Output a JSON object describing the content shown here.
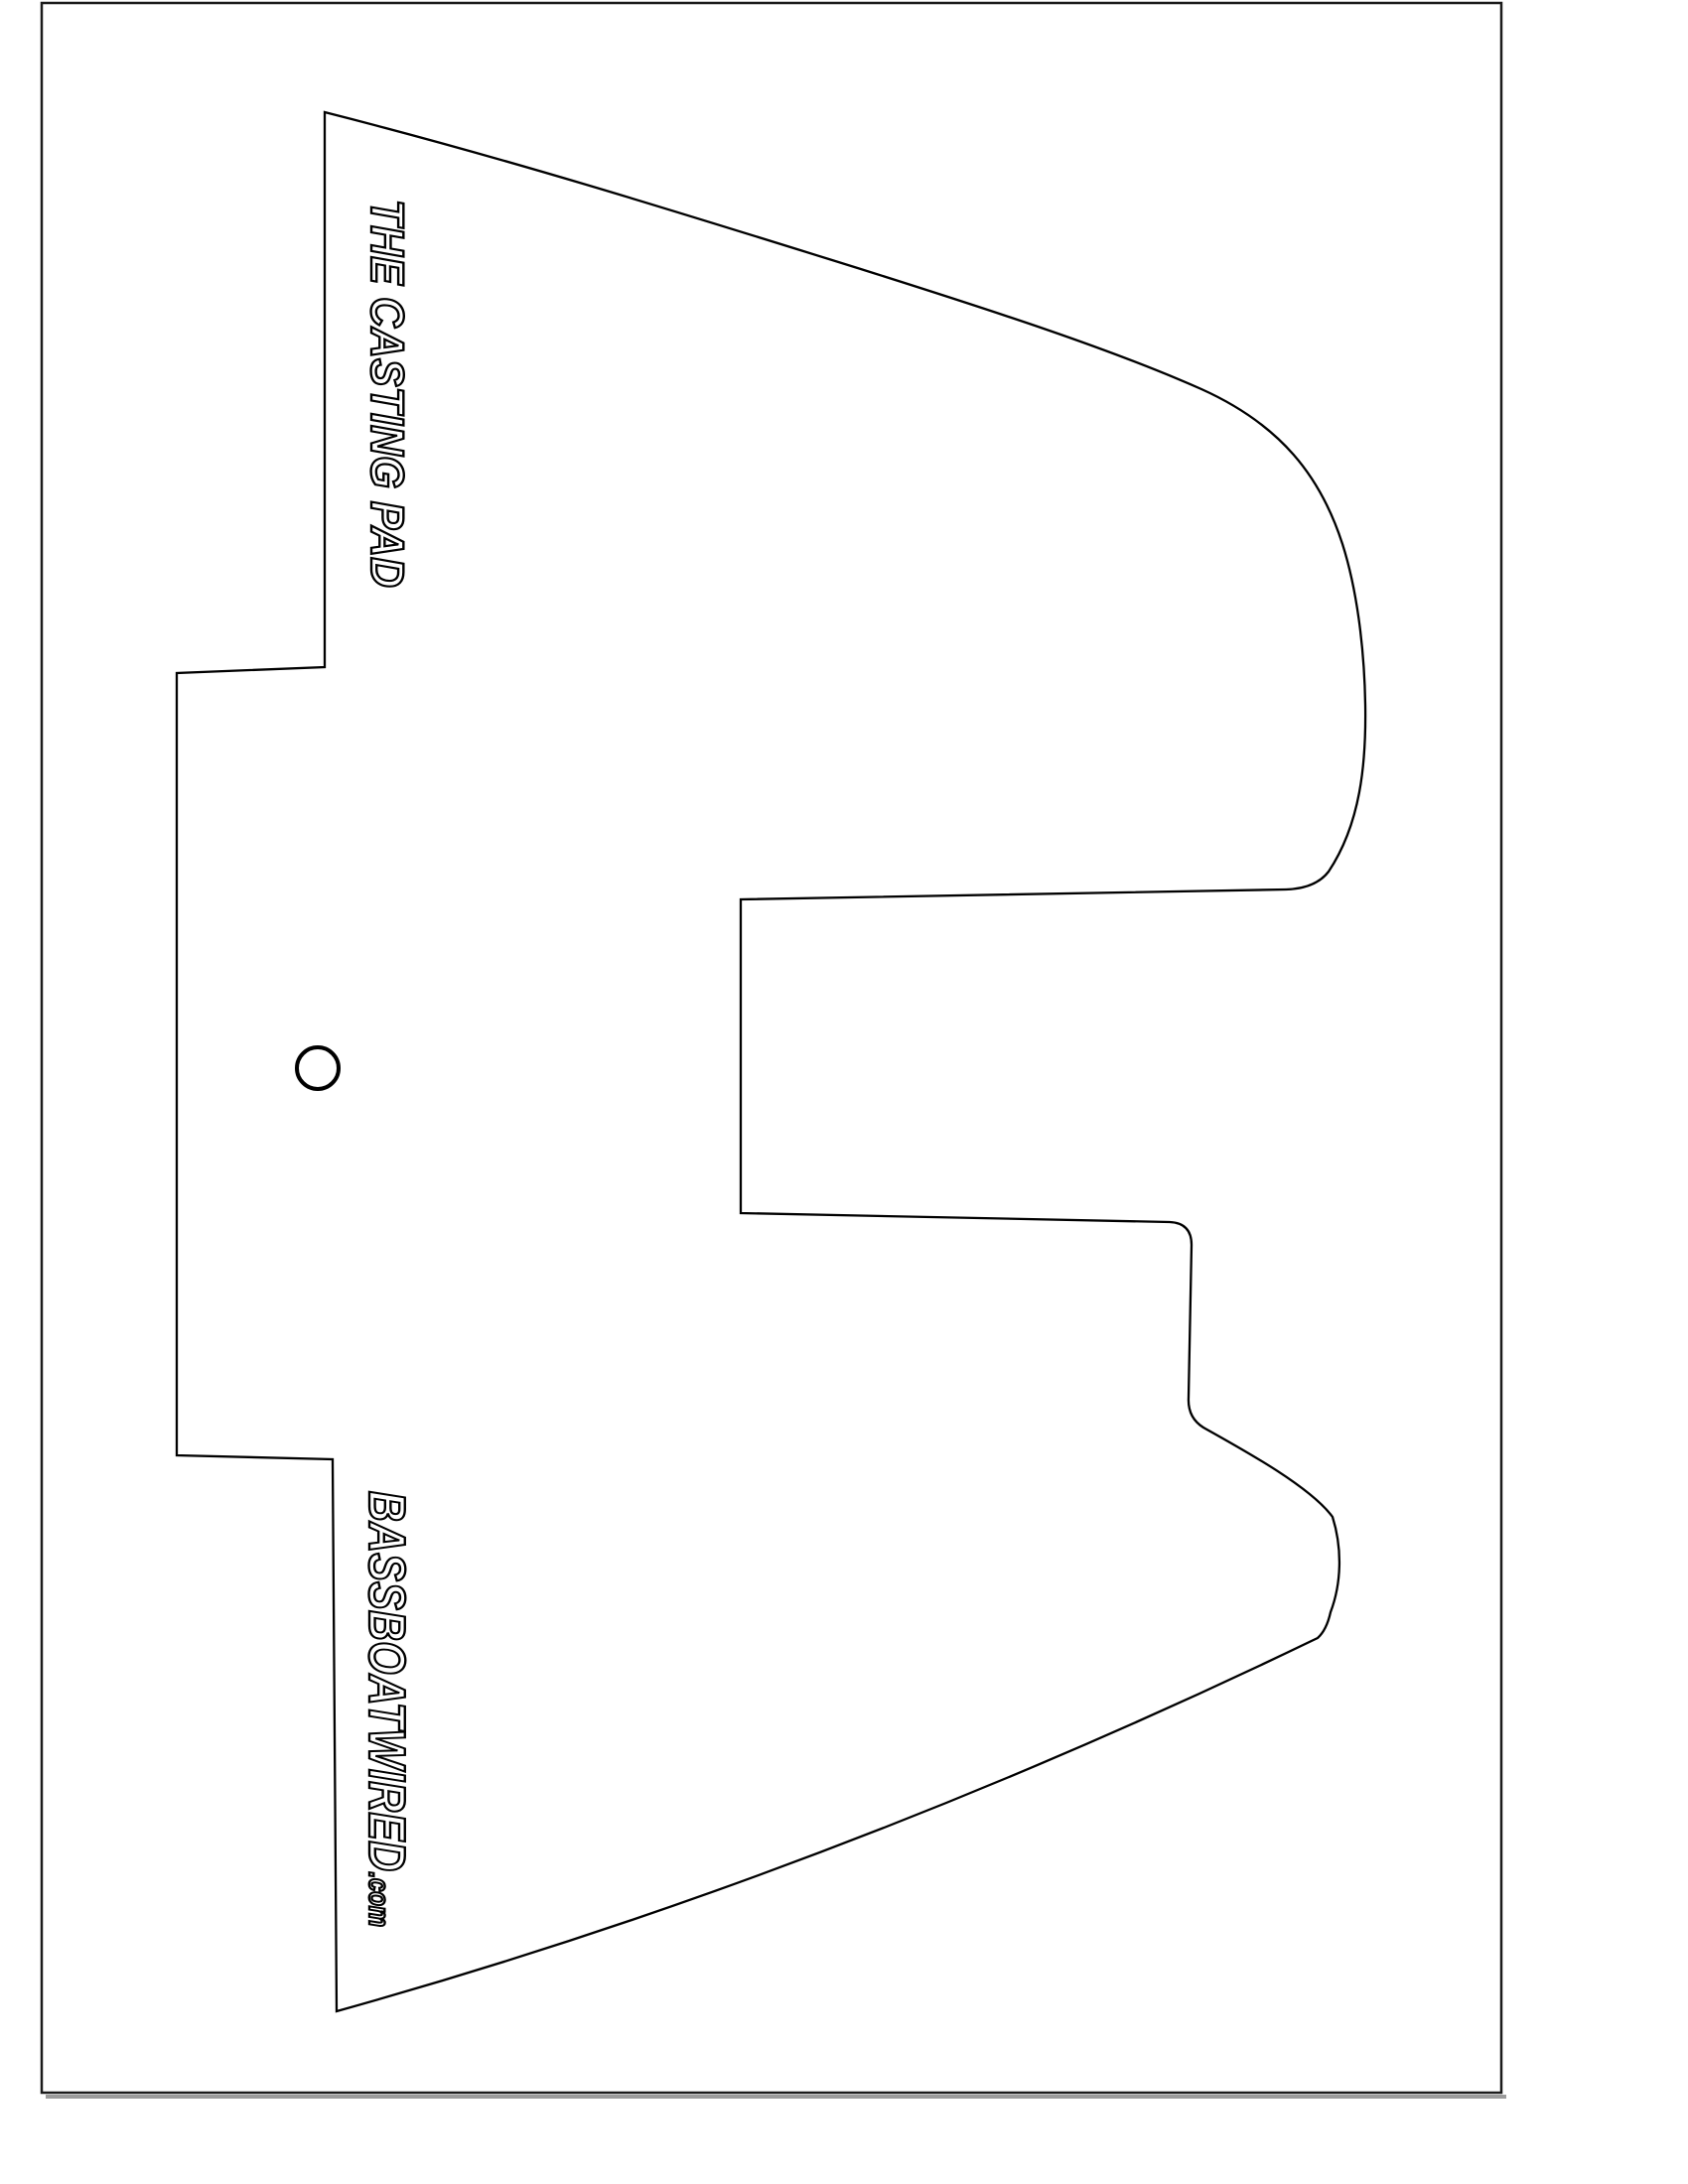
{
  "document": {
    "kind": "printable-template-page",
    "colors": {
      "background": "#ffffff",
      "page_border": "#1b1b1b",
      "page_border_shadow": "#9b9b9b",
      "template_outline": "#000000",
      "text_fill": "#ffffff",
      "text_outline": "#000000"
    }
  },
  "template": {
    "title": "THE CASTING PAD",
    "brand": "BASSBOATWIRED",
    "brand_suffix": ".com",
    "mounting_hole": "circle"
  }
}
